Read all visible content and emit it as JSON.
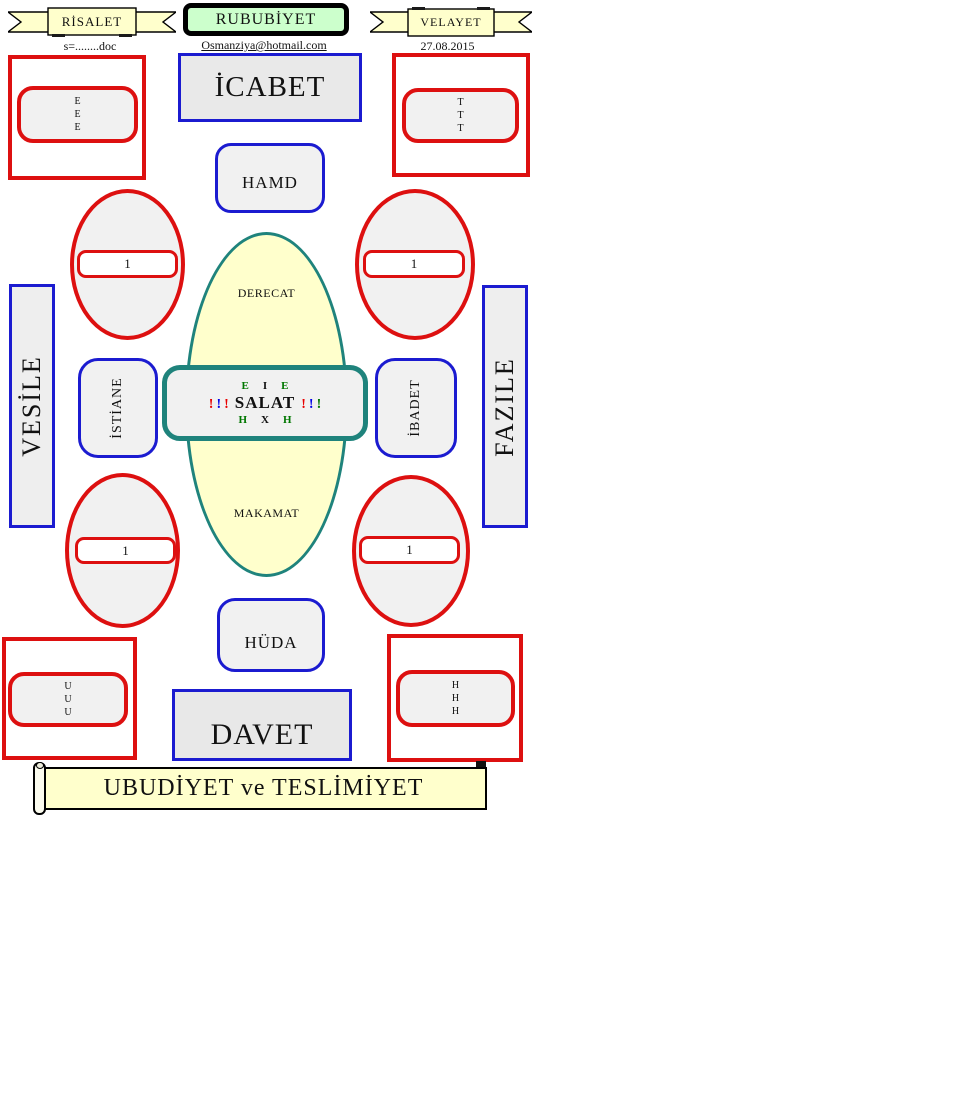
{
  "header": {
    "left_banner": "RİSALET",
    "center_box": "RUBUBİYET",
    "right_banner": "VELAYET",
    "left_sub": "s=........doc",
    "center_sub": "Osmanziya@hotmail.com",
    "right_sub": "27.08.2015"
  },
  "diagram": {
    "top_box": "İCABET",
    "hamd": "HAMD",
    "huda": "HÜDA",
    "bottom_box": "DAVET",
    "left_bar": "VESİLE",
    "right_bar": "FAZILE",
    "left_rounded": "İSTİANE",
    "right_rounded": "İBADET",
    "ellipse_top_label": "DERECAT",
    "ellipse_bottom_label": "MAKAMAT",
    "oval_value": "1",
    "corner_letters": {
      "top_left": [
        "E",
        "E",
        "E"
      ],
      "top_right": [
        "T",
        "T",
        "T"
      ],
      "bottom_left": [
        "U",
        "U",
        "U"
      ],
      "bottom_right": [
        "H",
        "H",
        "H"
      ]
    },
    "center": {
      "top_row": [
        {
          "t": "E",
          "c": "green"
        },
        {
          "t": "I",
          "c": "black"
        },
        {
          "t": "E",
          "c": "green"
        }
      ],
      "left_marks": [
        {
          "t": "!",
          "c": "red"
        },
        {
          "t": "!",
          "c": "blue"
        },
        {
          "t": "!",
          "c": "red"
        }
      ],
      "main_word": "SALAT",
      "right_marks": [
        {
          "t": "!",
          "c": "red"
        },
        {
          "t": "!",
          "c": "blue"
        },
        {
          "t": "!",
          "c": "green"
        }
      ],
      "bottom_row": [
        {
          "t": "H",
          "c": "green"
        },
        {
          "t": "X",
          "c": "black"
        },
        {
          "t": "H",
          "c": "green"
        }
      ]
    },
    "footer_banner": "UBUDİYET ve TESLİMİYET"
  },
  "colors": {
    "red": "#dd1010",
    "blue": "#1b1bd0",
    "teal": "#1f837c",
    "banner_yellow": "#ffffcc",
    "green_box_fill": "#ccffcc",
    "gray_fill": "#f1f1f1",
    "text_green": "#007700",
    "exclaim_red": "#e80000",
    "exclaim_blue": "#0000e8"
  }
}
